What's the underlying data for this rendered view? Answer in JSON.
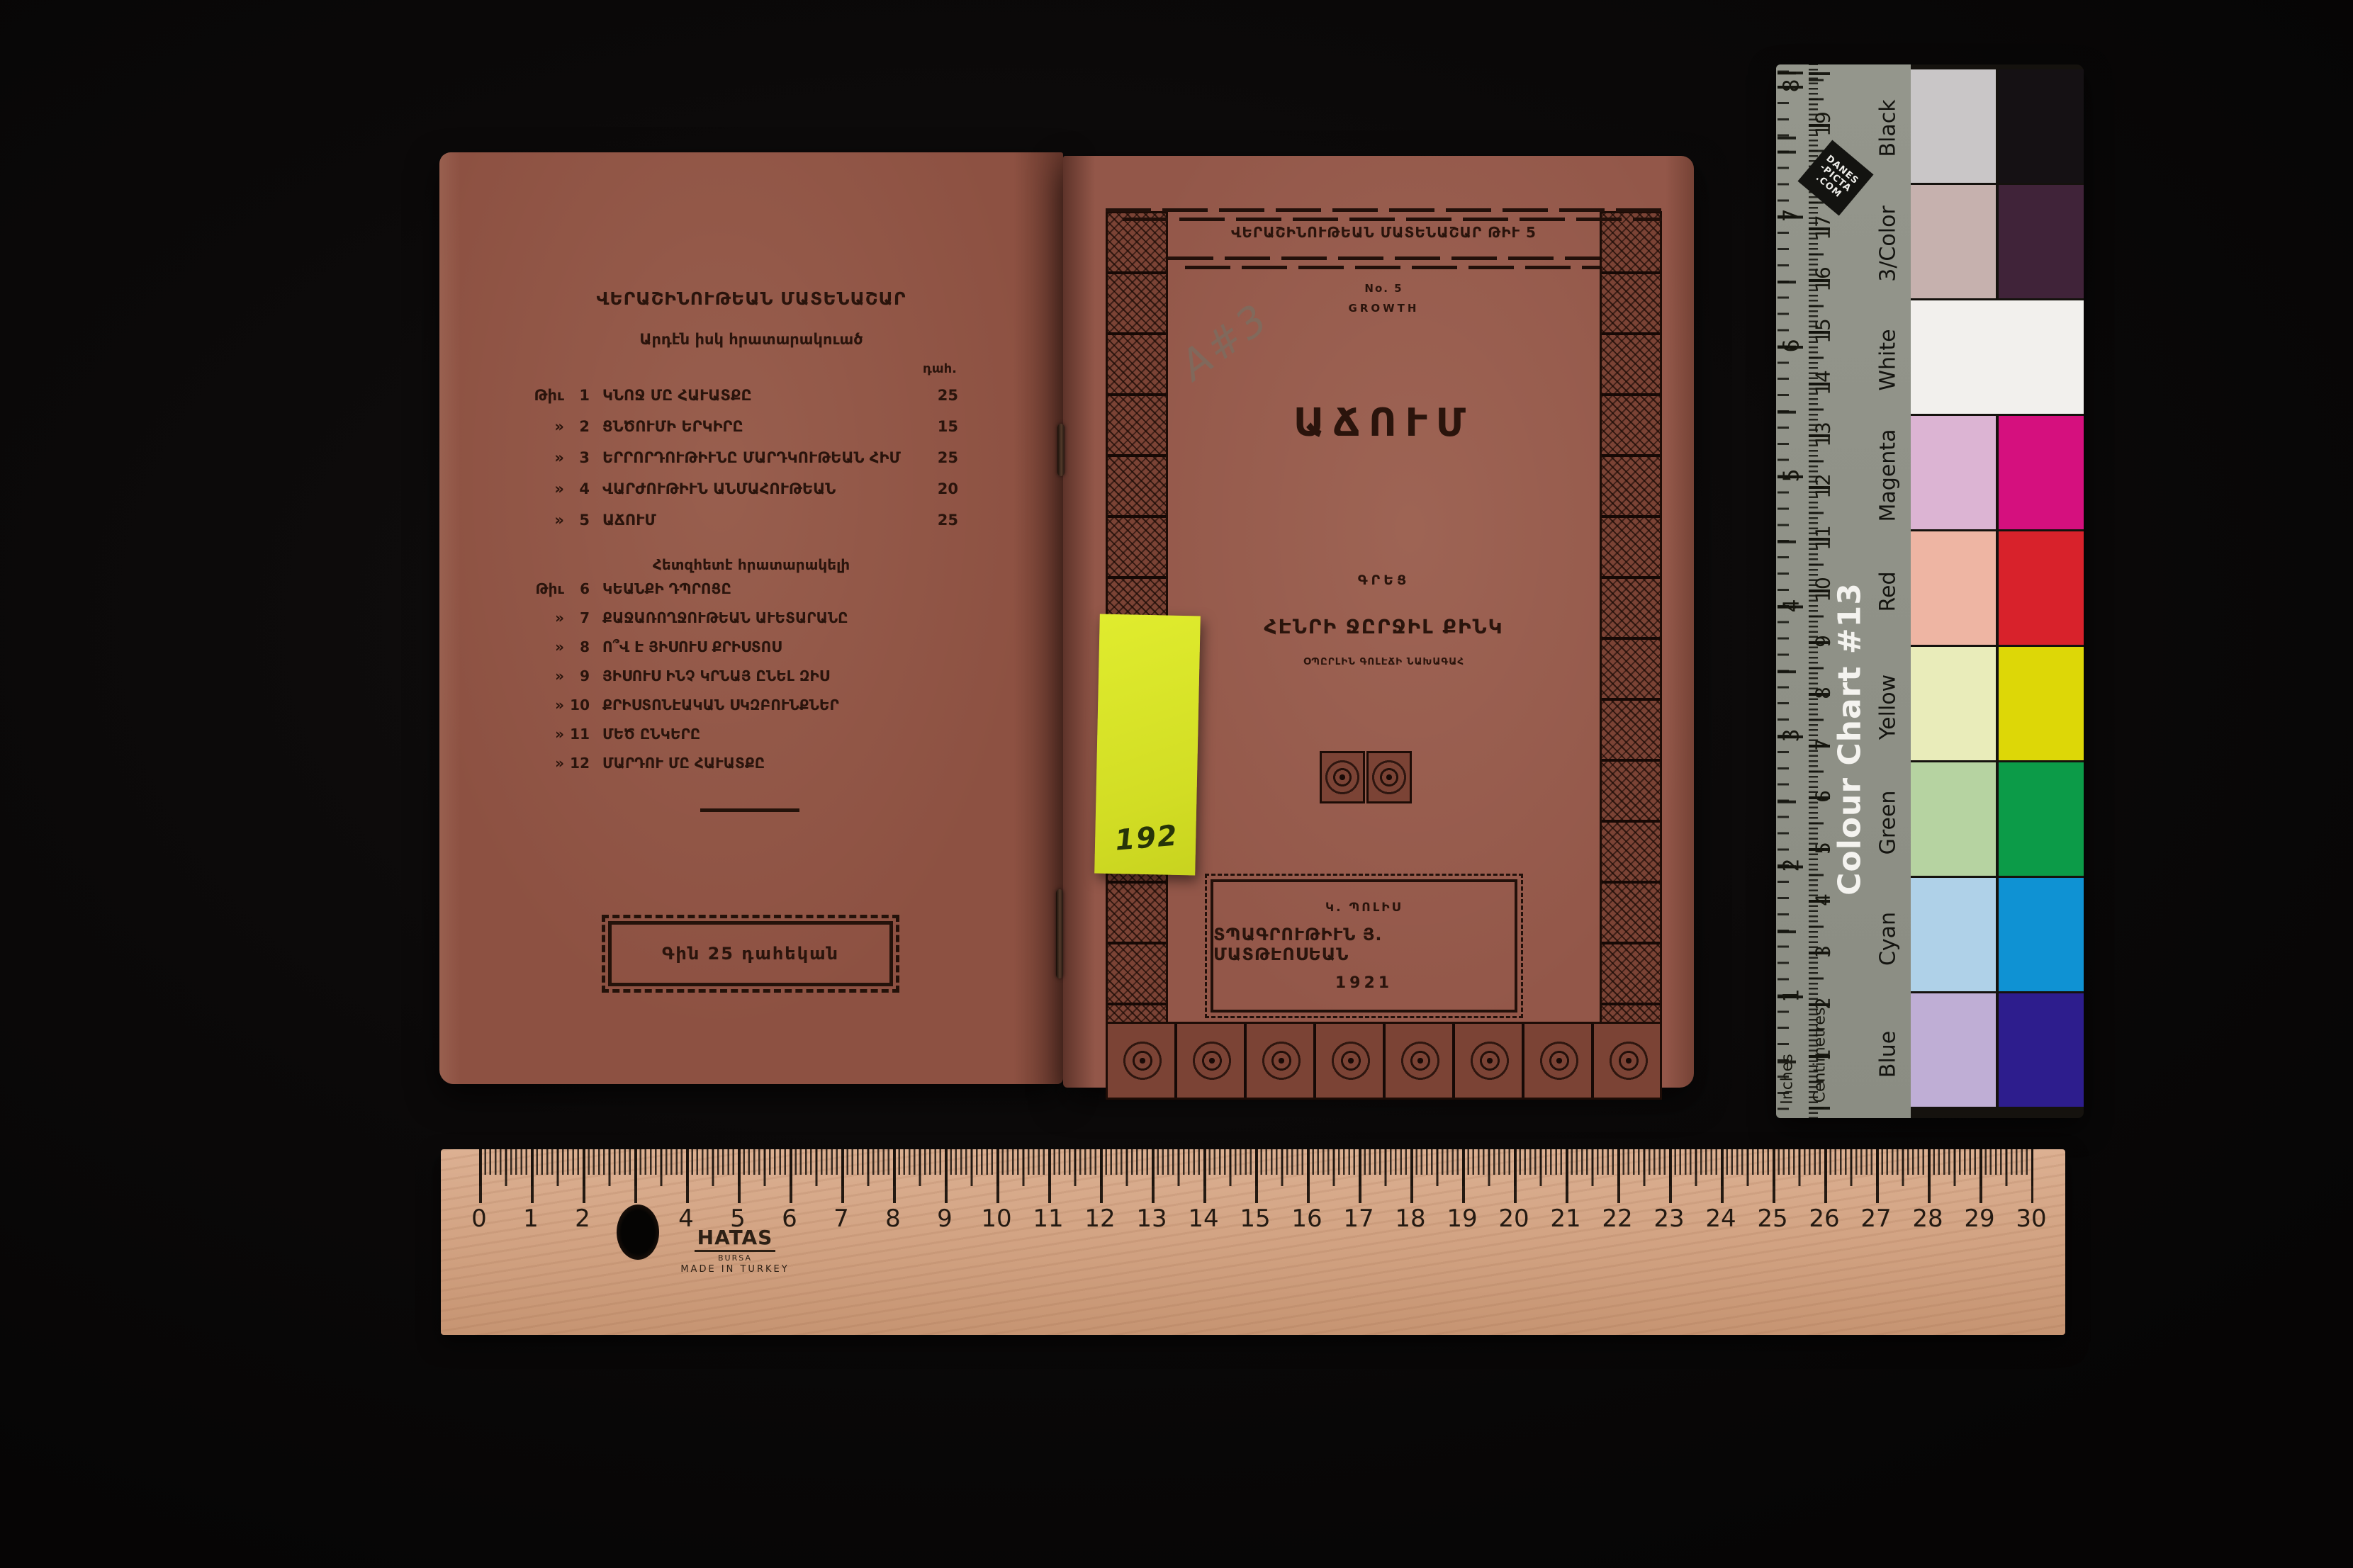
{
  "backcover": {
    "series_header": "ՎԵՐԱՇԻՆՈՒԹԵԱՆ ՄԱՏԵՆԱՇԱՐ",
    "published_label": "Արդէն իսկ հրատարակուած",
    "price_col": "դահ.",
    "published": [
      {
        "mark": "Թիւ",
        "no": "1",
        "title": "ԿՆՈՋ ՄԸ ՀԱՒԱՏՔԸ",
        "price": "25"
      },
      {
        "mark": "»",
        "no": "2",
        "title": "ՑՆԾՈՒՄԻ ԵՐԿԻՐԸ",
        "price": "15"
      },
      {
        "mark": "»",
        "no": "3",
        "title": "ԵՐՐՈՐԴՈՒԹԻՒՆԸ ՄԱՐԴԿՈՒԹԵԱՆ ՀԻՄ",
        "price": "25"
      },
      {
        "mark": "»",
        "no": "4",
        "title": "ՎԱՐԺՈՒԹԻՒՆ ԱՆՄԱՀՈՒԹԵԱՆ",
        "price": "20"
      },
      {
        "mark": "»",
        "no": "5",
        "title": "ԱՃՈՒՄ",
        "price": "25"
      }
    ],
    "upcoming_label": "Հետզհետէ հրատարակելի",
    "upcoming": [
      {
        "mark": "Թիւ",
        "no": "6",
        "title": "ԿԵԱՆՔԻ ԴՊՐՈՑԸ"
      },
      {
        "mark": "»",
        "no": "7",
        "title": "ՔԱՋԱՌՈՂՋՈՒԹԵԱՆ ԱՒԵՏԱՐԱՆԸ"
      },
      {
        "mark": "»",
        "no": "8",
        "title": "Ո՞Վ Է ՅԻՍՈՒՍ ՔՐԻՍՏՈՍ"
      },
      {
        "mark": "»",
        "no": "9",
        "title": "ՅԻՍՈՒՍ ԻՆՉ ԿՐՆԱՅ ԸՆԵԼ ԶԻՍ"
      },
      {
        "mark": "»",
        "no": "10",
        "title": "ՔՐԻՍՏՈՆԷԱԿԱՆ ՍԿԶԲՈՒՆՔՆԵՐ"
      },
      {
        "mark": "»",
        "no": "11",
        "title": "ՄԵԾ ԸՆԿԵՐԸ"
      },
      {
        "mark": "»",
        "no": "12",
        "title": "ՄԱՐԴՈՒ ՄԸ ՀԱՒԱՏՔԸ"
      }
    ],
    "price_box": "Գին 25 դահեկան"
  },
  "frontcover": {
    "series_line": "ՎԵՐԱՇԻՆՈՒԹԵԱՆ ՄԱՏԵՆԱՇԱՐ ԹԻՒ 5",
    "number_line": "No. 5",
    "growth": "GROWTH",
    "pencil_note": "A#3",
    "title": "ԱՃՈՒՄ",
    "wrote_label": "ԳՐԵՑ",
    "author": "ՀԷՆՐԻ ՋԸՐՋԻԼ ՔԻՆԿ",
    "author_sub": "ՕՊԸՐԼԻՆ ԳՈԼԷՃԻ ՆԱԽԱԳԱՀ",
    "city": "Կ. ՊՈԼԻՍ",
    "printer": "ՏՊԱԳՐՈՒԹԻՒՆ Յ. ՄԱՏԹԷՈՍԵԱՆ",
    "year": "1921"
  },
  "sticky_note": {
    "number": "192",
    "color": "#d9e428"
  },
  "color_chart": {
    "title": "Colour Chart #13",
    "brand_lines": [
      "DANES",
      "-PICTA",
      ".COM"
    ],
    "inches_label": "Inches",
    "cm_label": "Centimetres",
    "rows": [
      {
        "name": "Black",
        "light": "#c9c6c7",
        "dark": "#151114"
      },
      {
        "name": "3/Color",
        "light": "#c6b1ae",
        "dark": "#402339"
      },
      {
        "name": "White",
        "light": "#f2f0ed",
        "dark": "#f2f0ed"
      },
      {
        "name": "Magenta",
        "light": "#dcb4d3",
        "dark": "#d5107e"
      },
      {
        "name": "Red",
        "light": "#eeb5a3",
        "dark": "#d8222b"
      },
      {
        "name": "Yellow",
        "light": "#e9ecba",
        "dark": "#ddd707"
      },
      {
        "name": "Green",
        "light": "#b6d3a1",
        "dark": "#0c9b48"
      },
      {
        "name": "Cyan",
        "light": "#afd1e8",
        "dark": "#0f92d3"
      },
      {
        "name": "Blue",
        "light": "#bfaed5",
        "dark": "#2d1d8d"
      }
    ],
    "cm_numbers": [
      "19",
      "18",
      "17",
      "16",
      "15",
      "14",
      "13",
      "12",
      "11",
      "10",
      "9",
      "8",
      "7",
      "6",
      "5",
      "4",
      "3",
      "2",
      "1"
    ],
    "inch_numbers": [
      "8",
      "7",
      "6",
      "5",
      "4",
      "3",
      "2",
      "1"
    ]
  },
  "ruler": {
    "brand": "HATAS",
    "sub_brand": "BURSA",
    "made_in": "MADE IN TURKEY",
    "numbers": [
      "0",
      "1",
      "2",
      "3",
      "4",
      "5",
      "6",
      "7",
      "8",
      "9",
      "10",
      "11",
      "12",
      "13",
      "14",
      "15",
      "16",
      "17",
      "18",
      "19",
      "20",
      "21",
      "22",
      "23",
      "24",
      "25",
      "26",
      "27",
      "28",
      "29",
      "30"
    ]
  }
}
